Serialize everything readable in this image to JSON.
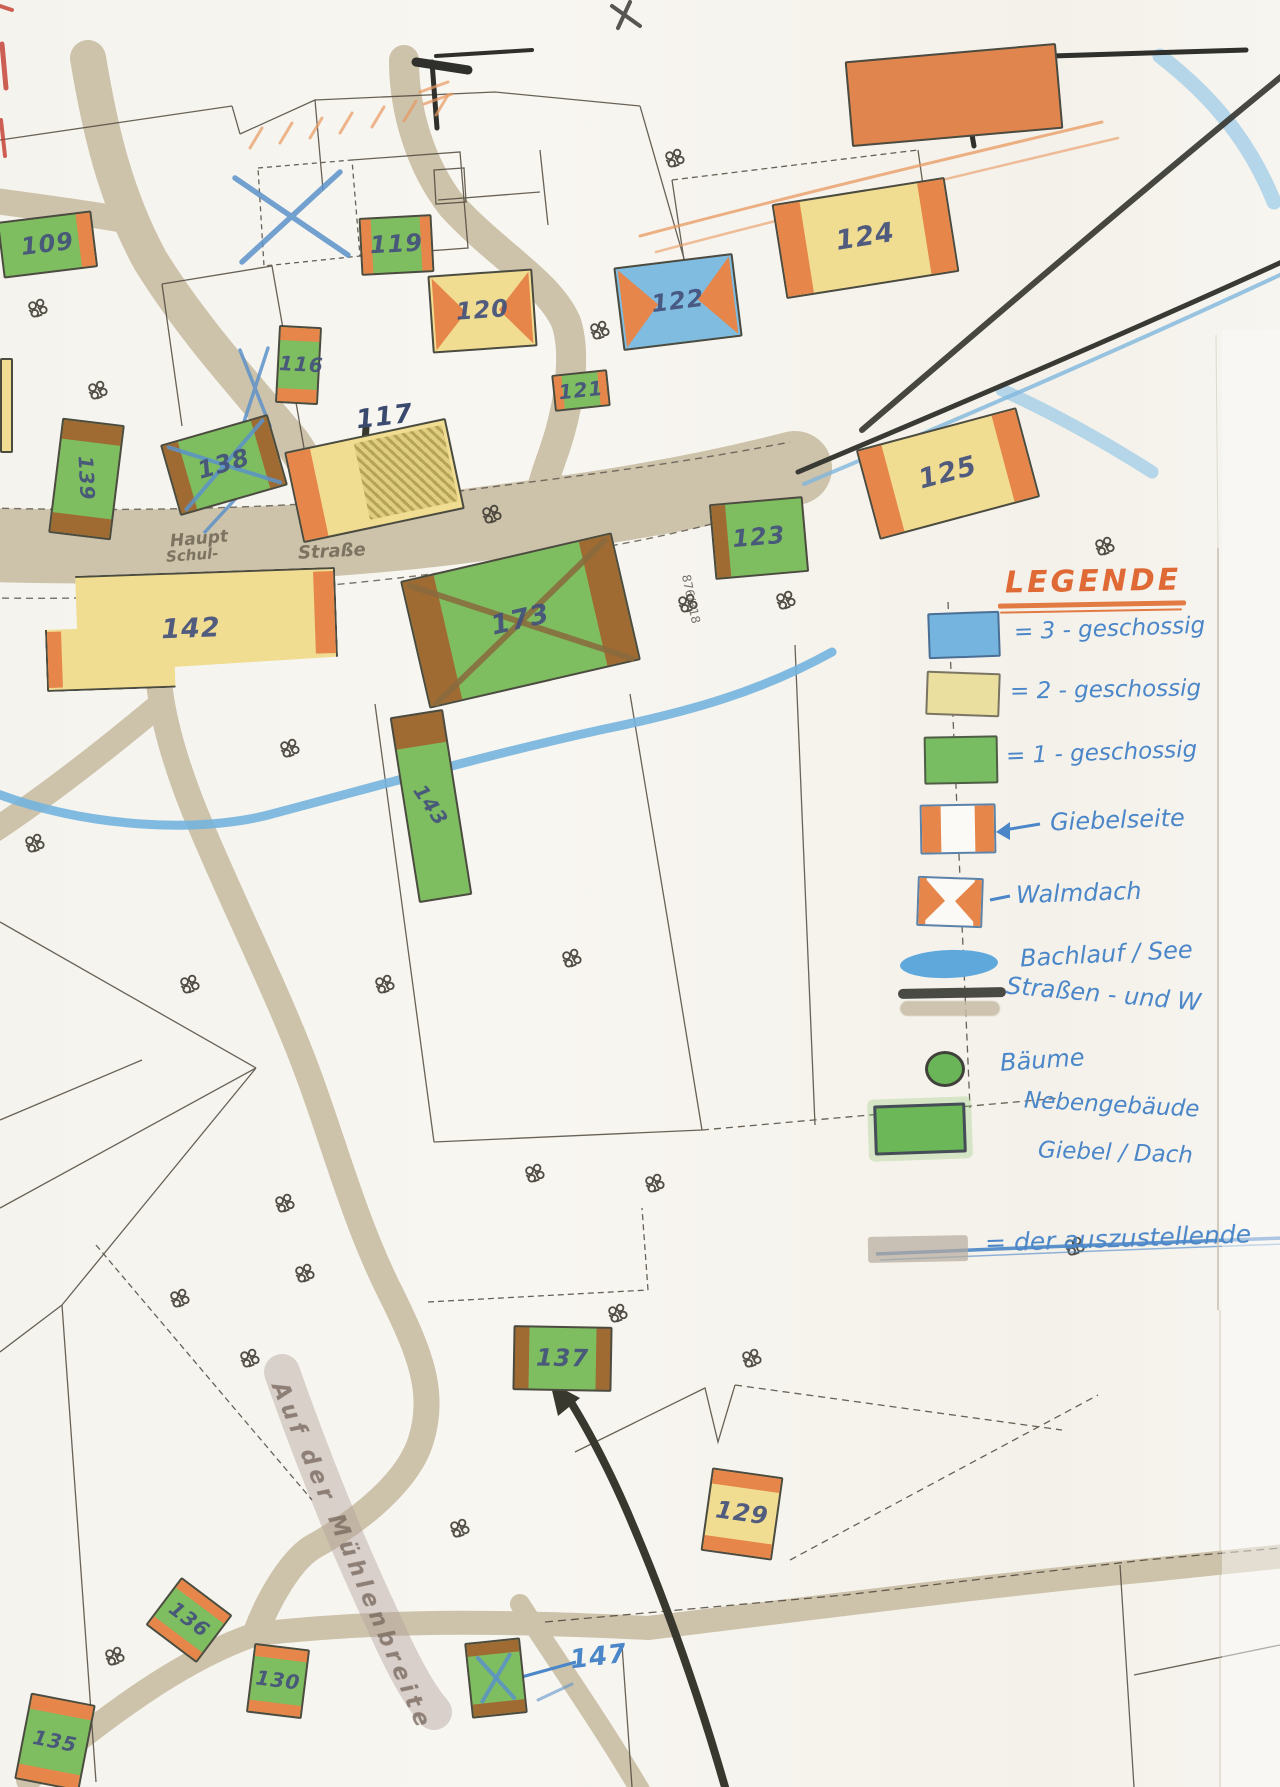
{
  "map": {
    "street_labels": [
      {
        "text": "Haupt",
        "x": 170,
        "y": 529,
        "rot": -5,
        "size": 17,
        "cls": ""
      },
      {
        "text": "Schul-",
        "x": 166,
        "y": 546,
        "rot": -4,
        "size": 15,
        "cls": ""
      },
      {
        "text": "Straße",
        "x": 298,
        "y": 541,
        "rot": -3,
        "size": 18,
        "cls": ""
      },
      {
        "text": "Auf der Mühlenbreite",
        "x": 290,
        "y": 1378,
        "rot": 67,
        "size": 23,
        "cls": "muehle"
      }
    ],
    "parcel_numbers": [
      {
        "text": "876/318",
        "x": 666,
        "y": 592,
        "rot": 78,
        "size": 12
      }
    ],
    "buildings": [
      {
        "n": "109",
        "x": 0,
        "y": 216,
        "w": 95,
        "h": 57,
        "rot": -7,
        "fill": "green",
        "caps": "r"
      },
      {
        "n": "119",
        "x": 360,
        "y": 216,
        "w": 73,
        "h": 58,
        "rot": -3,
        "fill": "green",
        "caps": "lr"
      },
      {
        "n": "120",
        "x": 430,
        "y": 272,
        "w": 105,
        "h": 78,
        "rot": -4,
        "fill": "yellow",
        "caps": "walm"
      },
      {
        "n": "122",
        "x": 618,
        "y": 260,
        "w": 120,
        "h": 84,
        "rot": -7,
        "fill": "blue",
        "caps": "walm"
      },
      {
        "n": "124",
        "x": 778,
        "y": 190,
        "w": 175,
        "h": 96,
        "rot": -9,
        "fill": "yellow",
        "caps": "lr"
      },
      {
        "n": "116",
        "x": 277,
        "y": 326,
        "w": 43,
        "h": 78,
        "rot": 3,
        "fill": "green",
        "caps": "tb"
      },
      {
        "n": "121",
        "x": 553,
        "y": 372,
        "w": 56,
        "h": 37,
        "rot": -6,
        "fill": "green",
        "caps": "lr"
      },
      {
        "n": "117",
        "x": 292,
        "y": 434,
        "w": 165,
        "h": 93,
        "rot": -12,
        "fill": "yellow",
        "caps": "l",
        "scribble": true,
        "labelOut": [
          356,
          402
        ]
      },
      {
        "n": "138",
        "x": 168,
        "y": 428,
        "w": 112,
        "h": 74,
        "rot": -16,
        "fill": "green",
        "caps": "lr",
        "capAlt": true,
        "cross": "blue"
      },
      {
        "n": "139",
        "x": 55,
        "y": 421,
        "w": 63,
        "h": 116,
        "rot": 7,
        "fill": "green",
        "caps": "tb",
        "capAlt": true,
        "labelRot": 80
      },
      {
        "n": "125",
        "x": 865,
        "y": 427,
        "w": 166,
        "h": 93,
        "rot": -15,
        "fill": "yellow",
        "caps": "lr"
      },
      {
        "n": "123",
        "x": 712,
        "y": 500,
        "w": 94,
        "h": 76,
        "rot": -5,
        "fill": "green",
        "caps": "l",
        "capAlt": true
      },
      {
        "n": "173",
        "x": 412,
        "y": 555,
        "w": 217,
        "h": 131,
        "rot": -13,
        "fill": "green",
        "caps": "lr",
        "capAlt": true,
        "cross": "brown"
      },
      {
        "n": "142",
        "x": 45,
        "y": 572,
        "w": 292,
        "h": 115,
        "rot": -2,
        "fill": "yellow",
        "caps": "custom142"
      },
      {
        "n": "143",
        "x": 404,
        "y": 712,
        "w": 54,
        "h": 188,
        "rot": -9,
        "fill": "green",
        "caps": "t",
        "capAlt": true,
        "labelRot": 65
      },
      {
        "n": "137",
        "x": 513,
        "y": 1326,
        "w": 99,
        "h": 65,
        "rot": 1,
        "fill": "green",
        "caps": "lr",
        "capAlt": true
      },
      {
        "n": "129",
        "x": 706,
        "y": 1472,
        "w": 72,
        "h": 84,
        "rot": 8,
        "fill": "yellow",
        "caps": "tb"
      },
      {
        "n": "136",
        "x": 157,
        "y": 1590,
        "w": 64,
        "h": 60,
        "rot": 37,
        "fill": "green",
        "caps": "tb"
      },
      {
        "n": "130",
        "x": 250,
        "y": 1646,
        "w": 56,
        "h": 70,
        "rot": 7,
        "fill": "green",
        "caps": "tb"
      },
      {
        "n": "135",
        "x": 22,
        "y": 1698,
        "w": 66,
        "h": 88,
        "rot": 11,
        "fill": "green",
        "caps": "tb"
      },
      {
        "n": "147",
        "x": 468,
        "y": 1640,
        "w": 56,
        "h": 76,
        "rot": -6,
        "fill": "green",
        "caps": "tb",
        "capAlt": true,
        "cross": "blue",
        "labelOut": [
          570,
          1642
        ],
        "labelColor": "blue"
      },
      {
        "n": "",
        "x": 848,
        "y": 52,
        "w": 212,
        "h": 86,
        "rot": -5,
        "fill": "orange",
        "caps": "none"
      },
      {
        "n": "",
        "x": 0,
        "y": 358,
        "w": 13,
        "h": 95,
        "rot": 0,
        "fill": "yellow",
        "caps": "none"
      }
    ]
  },
  "legend": {
    "title": "LEGENDE",
    "items": [
      {
        "id": "three-storey",
        "label": "= 3 - geschossig"
      },
      {
        "id": "two-storey",
        "label": "= 2 - geschossig"
      },
      {
        "id": "one-storey",
        "label": "= 1 - geschossig"
      },
      {
        "id": "gable-side",
        "label": "Giebelseite"
      },
      {
        "id": "hip-roof",
        "label": "Walmdach"
      },
      {
        "id": "watercourse",
        "label": "Bachlauf / See"
      },
      {
        "id": "roads",
        "label": "Straßen - und W"
      },
      {
        "id": "trees",
        "label": "Bäume"
      },
      {
        "id": "outbuilding",
        "label": "Nebengebäude",
        "label2": "Giebel / Dach"
      },
      {
        "id": "to-exhibit",
        "label": "= der auszustellende"
      }
    ]
  },
  "colors": {
    "one_storey_green": "#79bd62",
    "two_storey_yellow": "#eadf9e",
    "three_storey_blue": "#74b4de",
    "gable_orange": "#e6864a",
    "water_blue": "#6fb3dd",
    "road_tan": "#cdc2aa",
    "legend_heading_orange": "#e06a35",
    "handwriting_blue": "#4a86c8"
  }
}
